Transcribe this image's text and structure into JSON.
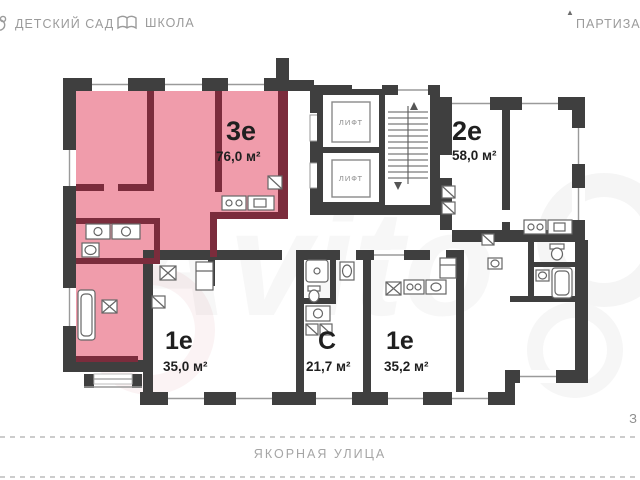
{
  "legend": {
    "kindergarten": "ДЕТСКИЙ САД",
    "school": "ШКОЛА"
  },
  "streets": {
    "top": "ПАРТИЗАНС",
    "bottom": "ЯКОРНАЯ УЛИЦА",
    "right_edge": "З"
  },
  "apartments": [
    {
      "type": "3е",
      "area": "76,0 м²",
      "highlighted": true
    },
    {
      "type": "2е",
      "area": "58,0 м²",
      "highlighted": false
    },
    {
      "type": "1е",
      "area": "35,0 м²",
      "highlighted": false
    },
    {
      "type": "С",
      "area": "21,7 м²",
      "highlighted": false
    },
    {
      "type": "1е",
      "area": "35,2 м²",
      "highlighted": false
    }
  ],
  "elevators": [
    {
      "label": "ЛИФТ"
    },
    {
      "label": "ЛИФТ"
    }
  ],
  "watermark": {
    "text": "Avito"
  },
  "colors": {
    "highlight_fill": "#f09cab",
    "highlight_wall": "#7b2c3c",
    "wall": "#3f3f3f",
    "muted_text": "#9b9b9b",
    "label_text": "#1f1f1f"
  }
}
